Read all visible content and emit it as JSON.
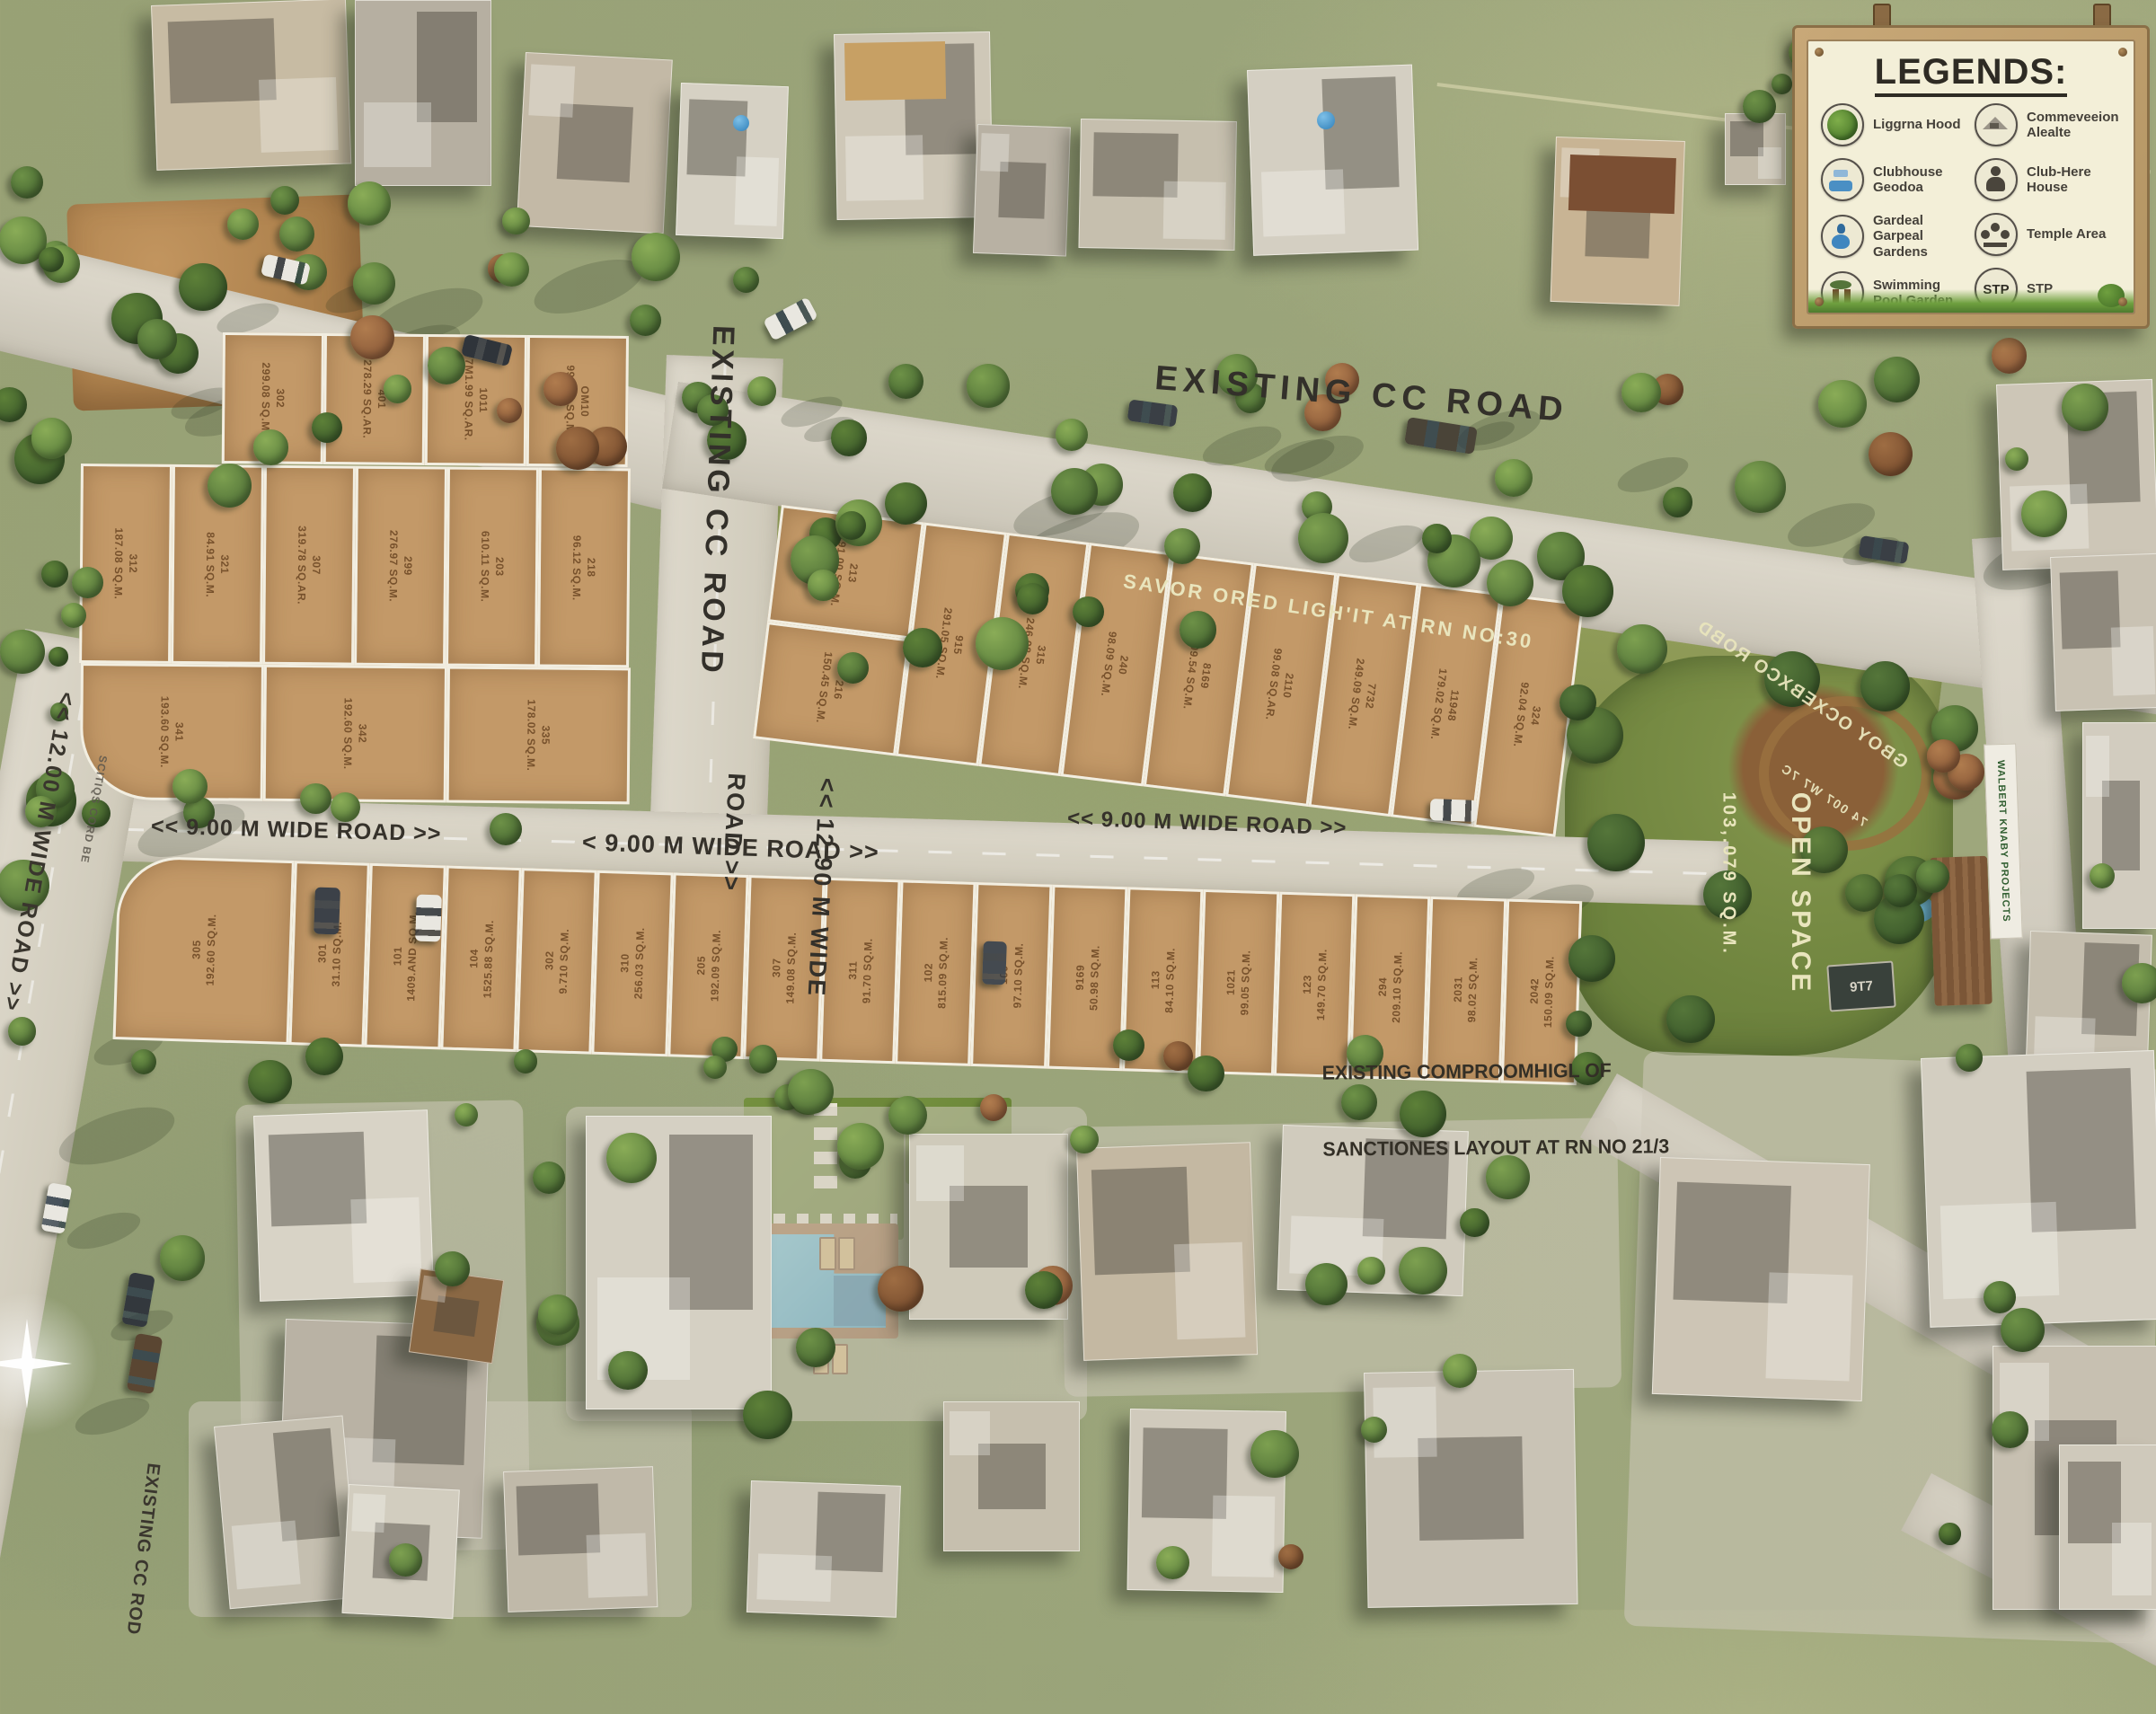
{
  "legend": {
    "title": "LEGENDS:",
    "left": [
      {
        "icon": "trees-icon",
        "label": "Liggrna Hood"
      },
      {
        "icon": "clubhouse-garden-icon",
        "label": "Clubhouse Geodoa"
      },
      {
        "icon": "garden-icon",
        "label": "Gardeal Garpeal Gardens"
      },
      {
        "icon": "swimming-pool-garden-icon",
        "label": "Swimming Pool Garden"
      }
    ],
    "right": [
      {
        "icon": "convention-icon",
        "label": "Commeveeion Alealte"
      },
      {
        "icon": "club-house-icon",
        "label": "Club-Here House"
      },
      {
        "icon": "temple-icon",
        "label": "Temple Area"
      },
      {
        "icon": "stp-icon",
        "label": "STP",
        "icon_text": "STP"
      }
    ]
  },
  "roads": {
    "existing_cc_road_top": "EXISTING CC ROAD",
    "existing_cc_road_vertical": "EXISTING CC ROAD",
    "wide_road_1290_line1": "<< 12.90 M WIDE",
    "wide_road_1290_line2": "ROAD >>",
    "wide_road_1200": "<< 12.00 M WIDE ROAD >>",
    "left_edge_small": "SCITIQS CORD BE",
    "wide_road_900_left": "<< 9.00 M WIDE ROAD >>",
    "wide_road_900_mid": "< 9.00 M WIDE ROAD >>",
    "wide_road_900_right": "<< 9.00 M WIDE ROAD >>",
    "existing_cc_rod_bottom": "EXISTING CC ROD"
  },
  "annotations": {
    "green_strip": "SAVOR ORED LIGH'IT AT RN NO:30",
    "compromise_line1": "EXISTING COMPROOMHIGL OF",
    "compromise_line2": "SANCTIONES LAYOUT AT RN NO 21/3",
    "open_space_line1": "OPEN SPACE",
    "open_space_line2": "103,.079 SQ.M.",
    "mirrored_road_line1": "GBOY OCXEBXCO ROBD",
    "mirrored_road_line2": "74 007 W7 7C",
    "stp_unit": "9T7",
    "right_sign": "WALBERT KNABY PROJECTS"
  },
  "plots": {
    "row_a0": [
      "302\n299.08 SQ.M.",
      "401\n278.29 SQ.AR.",
      "1011\n7M1.99 SQ.AR.",
      "OM10\n999.06 SQ.M."
    ],
    "row_a1": [
      "312\n187.08 SQ.M.",
      "321\n84.91 SQ.M.",
      "307\n319.78 SQ.AR.",
      "299\n276.97 SQ.M.",
      "203\n610.11 SQ.M.",
      "218\n96.12 SQ.M."
    ],
    "row_a2": [
      "341\n193.60 SQ.M.",
      "342\n192.60 SQ.M.",
      "335\n178.02 SQ.M."
    ],
    "row_b": [
      "213\n191.00 SQ.M.",
      "216\n150.45 SQ.M.",
      "915\n291.05 SQ.M.",
      "315\n246.98 SQ.M.",
      "240\n98.09 SQ.M.",
      "8169\n209.54 SQ.M.",
      "2110\n99.08 SQ.AR.",
      "7732\n249.09 SQ.M.",
      "11948\n179.02 SQ.M.",
      "324\n92.04 SQ.M."
    ],
    "row_c": [
      "305\n192.60 SQ.M.",
      "301\n31.10 SQ.M.",
      "101\n1409.AND SQ.M.",
      "104\n1525.88 SQ.M.",
      "302\n9.710 SQ.M.",
      "310\n256.03 SQ.M.",
      "205\n192.09 SQ.M.",
      "307\n149.08 SQ.M.",
      "311\n91.70 SQ.M.",
      "102\n815.09 SQ.M.",
      "109\n97.10 SQ.M.",
      "9169\n50.98 SQ.M.",
      "113\n84.10 SQ.M.",
      "1021\n99.05 SQ.M.",
      "123\n149.70 SQ.M.",
      "294\n209.10 SQ.M.",
      "2031\n98.02 SQ.M.",
      "2042\n150.09 SQ.M."
    ]
  }
}
